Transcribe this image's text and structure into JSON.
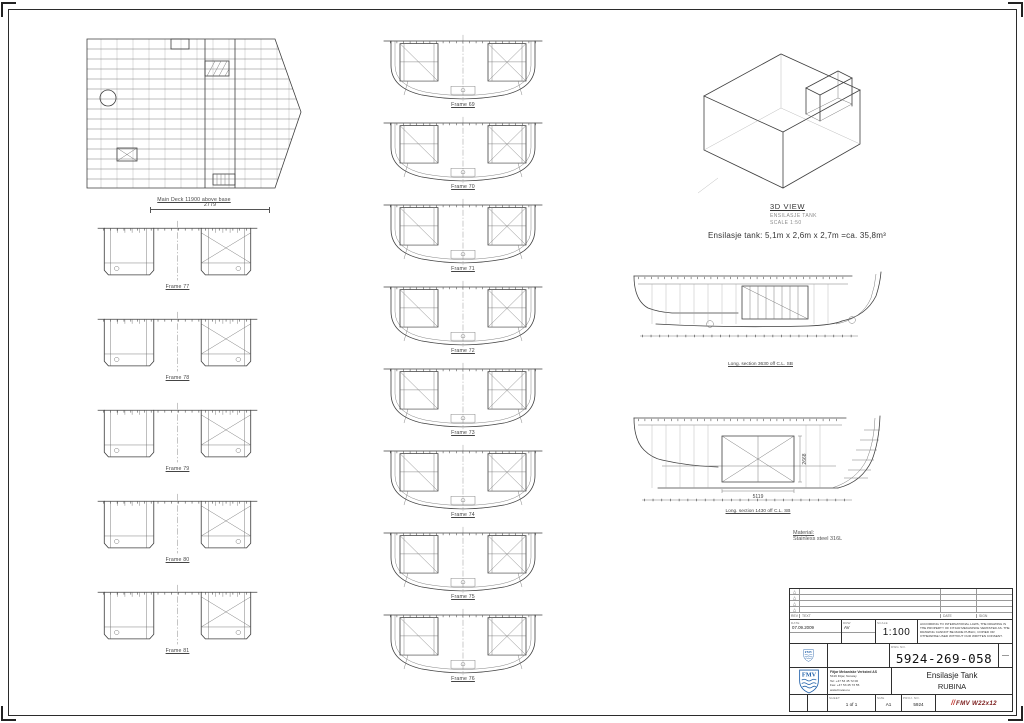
{
  "colors": {
    "logo_blue": "#1f5fa8",
    "stamp_red": "#c03028",
    "line": "#3f3f3f"
  },
  "plan_view": {
    "caption": "Main Deck 11900 above base"
  },
  "left_sections": {
    "dimension": "2779",
    "frames": [
      "Frame 77",
      "Frame 78",
      "Frame 79",
      "Frame 80",
      "Frame 81"
    ]
  },
  "mid_sections": {
    "frames": [
      "Frame 69",
      "Frame 70",
      "Frame 71",
      "Frame 72",
      "Frame 73",
      "Frame 74",
      "Frame 75",
      "Frame 76"
    ]
  },
  "view3d": {
    "title": "3D VIEW",
    "subtitle": "ENSILASJE TANK",
    "scale": "SCALE 1:50"
  },
  "tank_note": "Ensilasje tank: 5,1m x 2,6m x 2,7m =ca. 35,8m³",
  "long_section_1": {
    "caption": "Long. section 3630 off C.L. SB"
  },
  "long_section_2": {
    "caption": "Long. section 1430 off C.L. SB",
    "dim_width": "5119",
    "dim_height": "2668"
  },
  "material": {
    "label": "Material:",
    "value": "Stainless steel 316L"
  },
  "title_block": {
    "rev_marker": "△",
    "rev_header": {
      "rev": "REV",
      "text": "TEXT",
      "date": "DATE",
      "sign": "SIGN"
    },
    "fields": {
      "date_label": "DATE",
      "date": "07.09.2009",
      "drawn_label": "DRW",
      "drawn": "AV",
      "scale_label": "SCALE",
      "scale": "1:100"
    },
    "legal": "According to international laws, the drawing is the property of Fitjar Mekaniske Verksted AS. The drawing cannot be made public, copied or otherwise used without our written consent.",
    "dwg_no_label": "DWG NO.",
    "dwg_no": "5924-269-058",
    "rev_value": "—",
    "company": {
      "logo": "FMV",
      "name": "Fitjar Mekaniske Verksted AS",
      "addr": "5419 Fitjar, Norway",
      "tel": "Tel: +47 53 45 72 00",
      "fax": "Fax: +47 53 45 73 55",
      "web": "www.fmvas.no"
    },
    "title": "Ensilasje Tank",
    "subtitle": "RUBINA",
    "sheet_label": "SHEET",
    "sheet": "1 of 1",
    "size_label": "SIZE",
    "size": "A1",
    "proj_label": "PROJ. NO.",
    "proj": "5924",
    "stamp_slashes": "//",
    "stamp": "FMV W22x12"
  }
}
